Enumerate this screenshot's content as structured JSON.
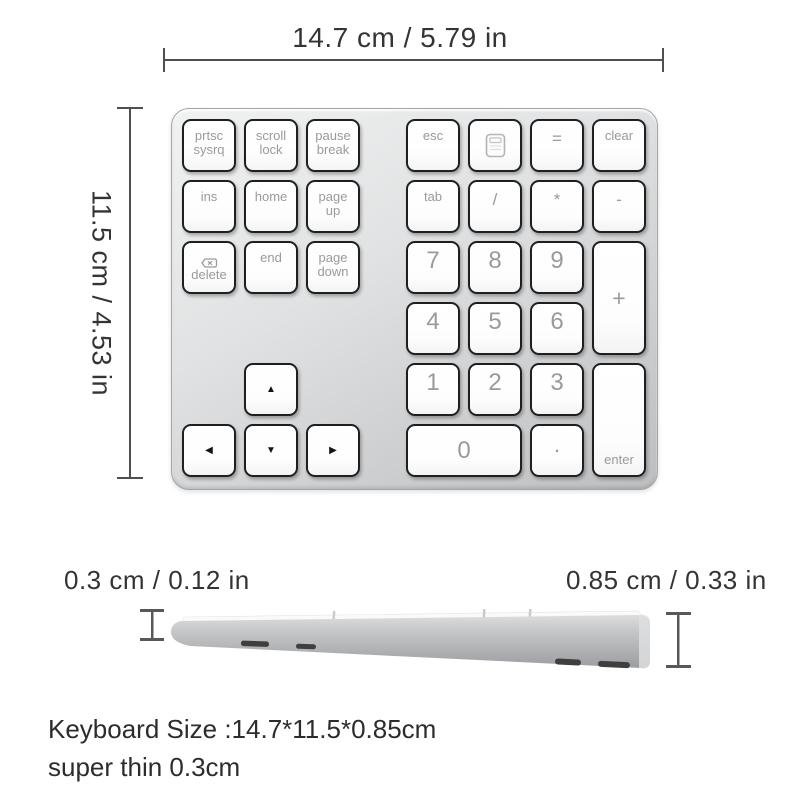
{
  "dimension_labels": {
    "top": "14.7 cm / 5.79 in",
    "left": "11.5 cm / 4.53 in",
    "bottom_left": "0.3 cm / 0.12 in",
    "bottom_right": "0.85 cm / 0.33 in"
  },
  "footer": {
    "line1": "Keyboard Size :14.7*11.5*0.85cm",
    "line2": "super thin 0.3cm"
  },
  "colors": {
    "dimension_lines": "#4f4f4f",
    "annotation_text": "#343434",
    "keypad_body": "#d6d8da",
    "key_face": "#ffffff",
    "key_border": "#1f1f1f",
    "key_label": "#9a9a9a"
  },
  "keypad": {
    "keys": [
      {
        "name": "key-prtsc-sysrq",
        "label": "prtsc\nsysrq",
        "variant": "text",
        "row": 1,
        "col": 1
      },
      {
        "name": "key-scroll-lock",
        "label": "scroll\nlock",
        "variant": "text",
        "row": 1,
        "col": 2
      },
      {
        "name": "key-pause-break",
        "label": "pause\nbreak",
        "variant": "text",
        "row": 1,
        "col": 3
      },
      {
        "name": "key-esc",
        "label": "esc",
        "variant": "text",
        "row": 1,
        "col": 5
      },
      {
        "name": "key-calculator",
        "label": "",
        "variant": "calc",
        "icon": "calculator-icon",
        "row": 1,
        "col": 6
      },
      {
        "name": "key-equals",
        "label": "=",
        "variant": "sym",
        "row": 1,
        "col": 7
      },
      {
        "name": "key-clear",
        "label": "clear",
        "variant": "text",
        "row": 1,
        "col": 8
      },
      {
        "name": "key-ins",
        "label": "ins",
        "variant": "text",
        "row": 2,
        "col": 1
      },
      {
        "name": "key-home",
        "label": "home",
        "variant": "text",
        "row": 2,
        "col": 2
      },
      {
        "name": "key-page-up",
        "label": "page\nup",
        "variant": "text",
        "row": 2,
        "col": 3
      },
      {
        "name": "key-tab",
        "label": "tab",
        "variant": "text",
        "row": 2,
        "col": 5
      },
      {
        "name": "key-divide",
        "label": "/",
        "variant": "sym",
        "row": 2,
        "col": 6
      },
      {
        "name": "key-multiply",
        "label": "*",
        "variant": "sym",
        "row": 2,
        "col": 7
      },
      {
        "name": "key-minus",
        "label": "-",
        "variant": "sym",
        "row": 2,
        "col": 8
      },
      {
        "name": "key-delete",
        "label": "delete",
        "variant": "delete",
        "icon": "delete-forward-icon",
        "row": 3,
        "col": 1
      },
      {
        "name": "key-end",
        "label": "end",
        "variant": "text",
        "row": 3,
        "col": 2
      },
      {
        "name": "key-page-down",
        "label": "page\ndown",
        "variant": "text",
        "row": 3,
        "col": 3
      },
      {
        "name": "key-7",
        "label": "7",
        "variant": "num",
        "row": 3,
        "col": 5
      },
      {
        "name": "key-8",
        "label": "8",
        "variant": "num",
        "row": 3,
        "col": 6
      },
      {
        "name": "key-9",
        "label": "9",
        "variant": "num",
        "row": 3,
        "col": 7
      },
      {
        "name": "key-plus",
        "label": "+",
        "variant": "plus",
        "row": 3,
        "col": 8,
        "rowspan": 2
      },
      {
        "name": "key-4",
        "label": "4",
        "variant": "num",
        "row": 4,
        "col": 5
      },
      {
        "name": "key-5",
        "label": "5",
        "variant": "num",
        "row": 4,
        "col": 6
      },
      {
        "name": "key-6",
        "label": "6",
        "variant": "num",
        "row": 4,
        "col": 7
      },
      {
        "name": "key-arrow-up",
        "label": "▲",
        "variant": "arrow",
        "row": 5,
        "col": 2
      },
      {
        "name": "key-1",
        "label": "1",
        "variant": "num",
        "row": 5,
        "col": 5
      },
      {
        "name": "key-2",
        "label": "2",
        "variant": "num",
        "row": 5,
        "col": 6
      },
      {
        "name": "key-3",
        "label": "3",
        "variant": "num",
        "row": 5,
        "col": 7
      },
      {
        "name": "key-enter",
        "label": "enter",
        "variant": "enter",
        "row": 5,
        "col": 8,
        "rowspan": 2
      },
      {
        "name": "key-arrow-left",
        "label": "◀",
        "variant": "arrow",
        "row": 6,
        "col": 1
      },
      {
        "name": "key-arrow-down",
        "label": "▼",
        "variant": "arrow",
        "row": 6,
        "col": 2
      },
      {
        "name": "key-arrow-right",
        "label": "▶",
        "variant": "arrow",
        "row": 6,
        "col": 3
      },
      {
        "name": "key-0",
        "label": "0",
        "variant": "zero",
        "row": 6,
        "col": 5,
        "colspan": 2
      },
      {
        "name": "key-period",
        "label": ".",
        "variant": "dot",
        "row": 6,
        "col": 7
      }
    ]
  }
}
